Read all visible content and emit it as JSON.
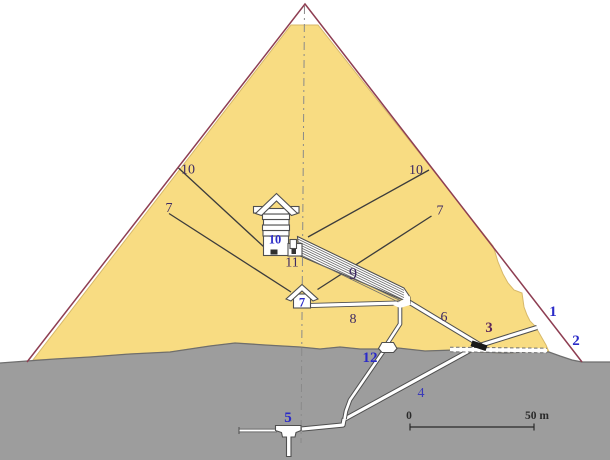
{
  "diagram": {
    "colors": {
      "masonry_yellow": "#f8dc82",
      "casing_maroon": "#8e3e52",
      "bedrock_gray": "#9d9d9d",
      "label_blue": "#2b2bc8",
      "label_dark": "#3e2a63",
      "plug_black": "#1a1a1a"
    },
    "labels": {
      "original_entrance": "1",
      "robbers_tunnel": "2",
      "granite_plugs": "3",
      "descending_passage": "4",
      "subterranean_chamber": "5",
      "ascending_passage": "6",
      "queens_chamber": "7",
      "queens_air_shaft_north": "7",
      "queens_air_shaft_south": "7",
      "horizontal_passage": "8",
      "grand_gallery": "9",
      "kings_chamber": "10",
      "kings_air_shaft_north": "10",
      "kings_air_shaft_south": "10",
      "antechamber": "11",
      "well_shaft": "12"
    },
    "scale_bar": {
      "zero": "0",
      "max": "50 m"
    }
  }
}
